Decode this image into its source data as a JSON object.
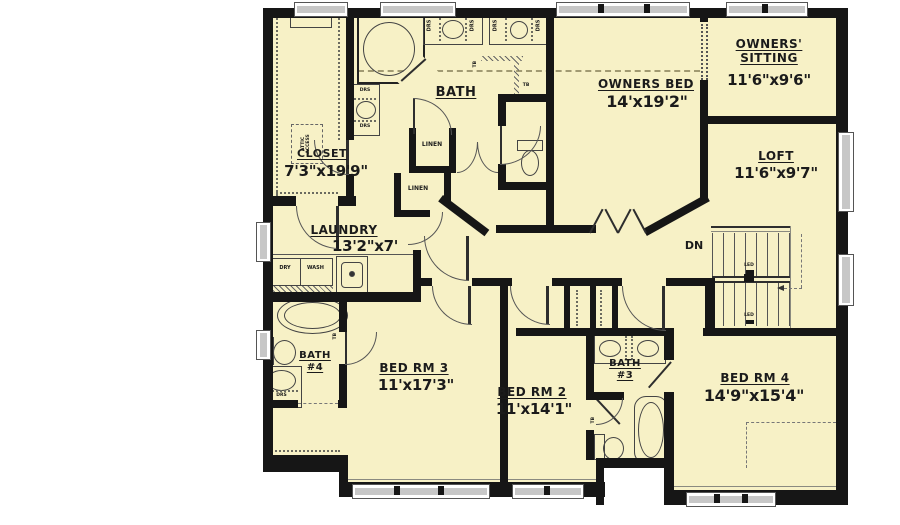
{
  "palette": {
    "floor": "#f7f1c6",
    "wall": "#161616",
    "line": "#555555",
    "window_gray": "#c7c7c7"
  },
  "rooms": {
    "closet": {
      "name": "CLOSET",
      "dims": "7'3\"x19'9\""
    },
    "bath": {
      "name": "BATH"
    },
    "owners_bed": {
      "name": "OWNERS BED",
      "dims": "14'x19'2\""
    },
    "owners_sitting": {
      "name": "OWNERS'\nSITTING",
      "dims": "11'6\"x9'6\""
    },
    "loft": {
      "name": "LOFT",
      "dims": "11'6\"x9'7\""
    },
    "laundry": {
      "name": "LAUNDRY",
      "dims": "13'2\"x7'"
    },
    "bath4": {
      "name": "BATH\n#4"
    },
    "bed3": {
      "name": "BED RM 3",
      "dims": "11'x17'3\""
    },
    "bed2": {
      "name": "BED RM 2",
      "dims": "11'x14'1\""
    },
    "bath3": {
      "name": "BATH\n#3"
    },
    "bed4": {
      "name": "BED RM 4",
      "dims": "14'9\"x15'4\""
    }
  },
  "labels": {
    "linen": "LINEN",
    "dry": "DRY",
    "wash": "WASH",
    "drs": "DRS",
    "tb": "TB",
    "dn": "DN",
    "led": "LED",
    "attic_access": "ATTIC\nACCESS"
  }
}
